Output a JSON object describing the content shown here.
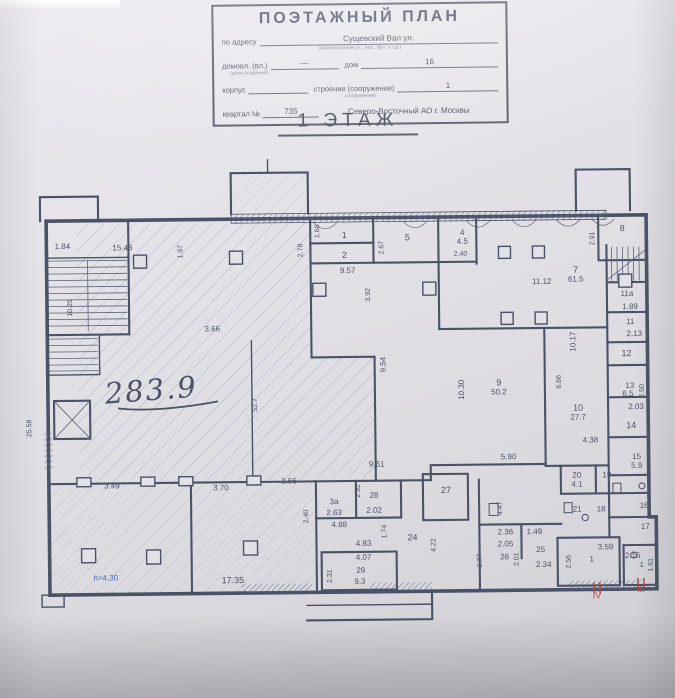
{
  "document": {
    "title": "ПОЭТАЖНЫЙ ПЛАН",
    "address_label": "по адресу",
    "address_value": "Сущевский Вал ул.",
    "address_note": "(наименование ул., пер., бул. и т.д.)",
    "ownership_label": "домовл. (вл.)",
    "ownership_value": "—",
    "house_label": "дом",
    "house_value": "16",
    "ownership_note": "(доля владения)",
    "korpus_label": "корпус",
    "stroenie_label": "строение (сооружение)",
    "stroenie_value": "1",
    "stroenie_note": "(сооружения)",
    "kvartal_label": "квартал №",
    "kvartal_value": "735",
    "okrug_value": "Северо-Восточный АО г. Москвы"
  },
  "floor_heading": "1 ЭТАЖ",
  "plan": {
    "handwritten_area": "283.9",
    "height_note": "h=4.30",
    "rooms": {
      "r1": "1",
      "r2": "2",
      "r3a": "3а",
      "r4": "4",
      "r5": "5",
      "r7": "7",
      "r8": "8",
      "r9": "9",
      "r10": "10",
      "r11": "11",
      "r11a": "11а",
      "r12": "12",
      "r13": "13",
      "r14": "14",
      "r15": "15",
      "r16": "16",
      "r17": "17",
      "r18": "18",
      "r19": "19",
      "r20": "20",
      "r21": "21",
      "r24": "24",
      "r25": "25",
      "r26": "26",
      "r27": "27",
      "r28": "28",
      "r29": "29",
      "tambour4": "1",
      "tambour3": "1"
    },
    "areas": {
      "a4_5": "4.5",
      "a61_5": "61.5",
      "a50_2": "50.2",
      "a27_7": "27.7",
      "a6_5": "6.5",
      "a5_9": "5.9",
      "a4_1": "4.1",
      "a9_3": "9.3"
    },
    "dims": {
      "d1_84": "1.84",
      "d15_48": "15.48",
      "d1_97": "1.97",
      "d2_78": "2.78",
      "d3_66a": "3.66",
      "d3_66b": "3.66",
      "d52_7": "52.7",
      "d10_29": "10.29",
      "d25_58": "25.58",
      "d3_49": "3.49",
      "d3_70": "3.70",
      "d17_35": "17.35",
      "d1_60": "1.60",
      "d9_57": "9.57",
      "d3_92": "3.92",
      "d2_67": "2.67",
      "d2_40a": "2.40",
      "d9_54": "9.54",
      "d11_12": "11.12",
      "d2_91": "2.91",
      "d1_89": "1.89",
      "d2_13": "2.13",
      "d10_30": "10.30",
      "d10_17": "10.17",
      "d6_66": "6.66",
      "d4_38": "4.38",
      "d5_90": "5.90",
      "d2_50": "2.50",
      "d2_03": "2.03",
      "d9_61": "9.61",
      "d2_63": "2.63",
      "d2_40b": "2.40",
      "d2_92": "2.92",
      "d4_88": "4.88",
      "d1_74": "1.74",
      "d2_02": "2.02",
      "d4_83": "4.83",
      "d4_07": "4.07",
      "d2_31": "2.31",
      "d4_22": "4.22",
      "d4_47": "4.47",
      "d2_77": "2.77",
      "d2_36": "2.36",
      "d1_49": "1.49",
      "d2_05": "2.05",
      "d2_01": "2.01",
      "d2_34": "2.34",
      "d3_59": "3.59",
      "d2_56": "2.56",
      "d2_15": "2.15",
      "d1_61": "1.61"
    },
    "entrances": {
      "e4": "IV",
      "e3": "III"
    }
  }
}
